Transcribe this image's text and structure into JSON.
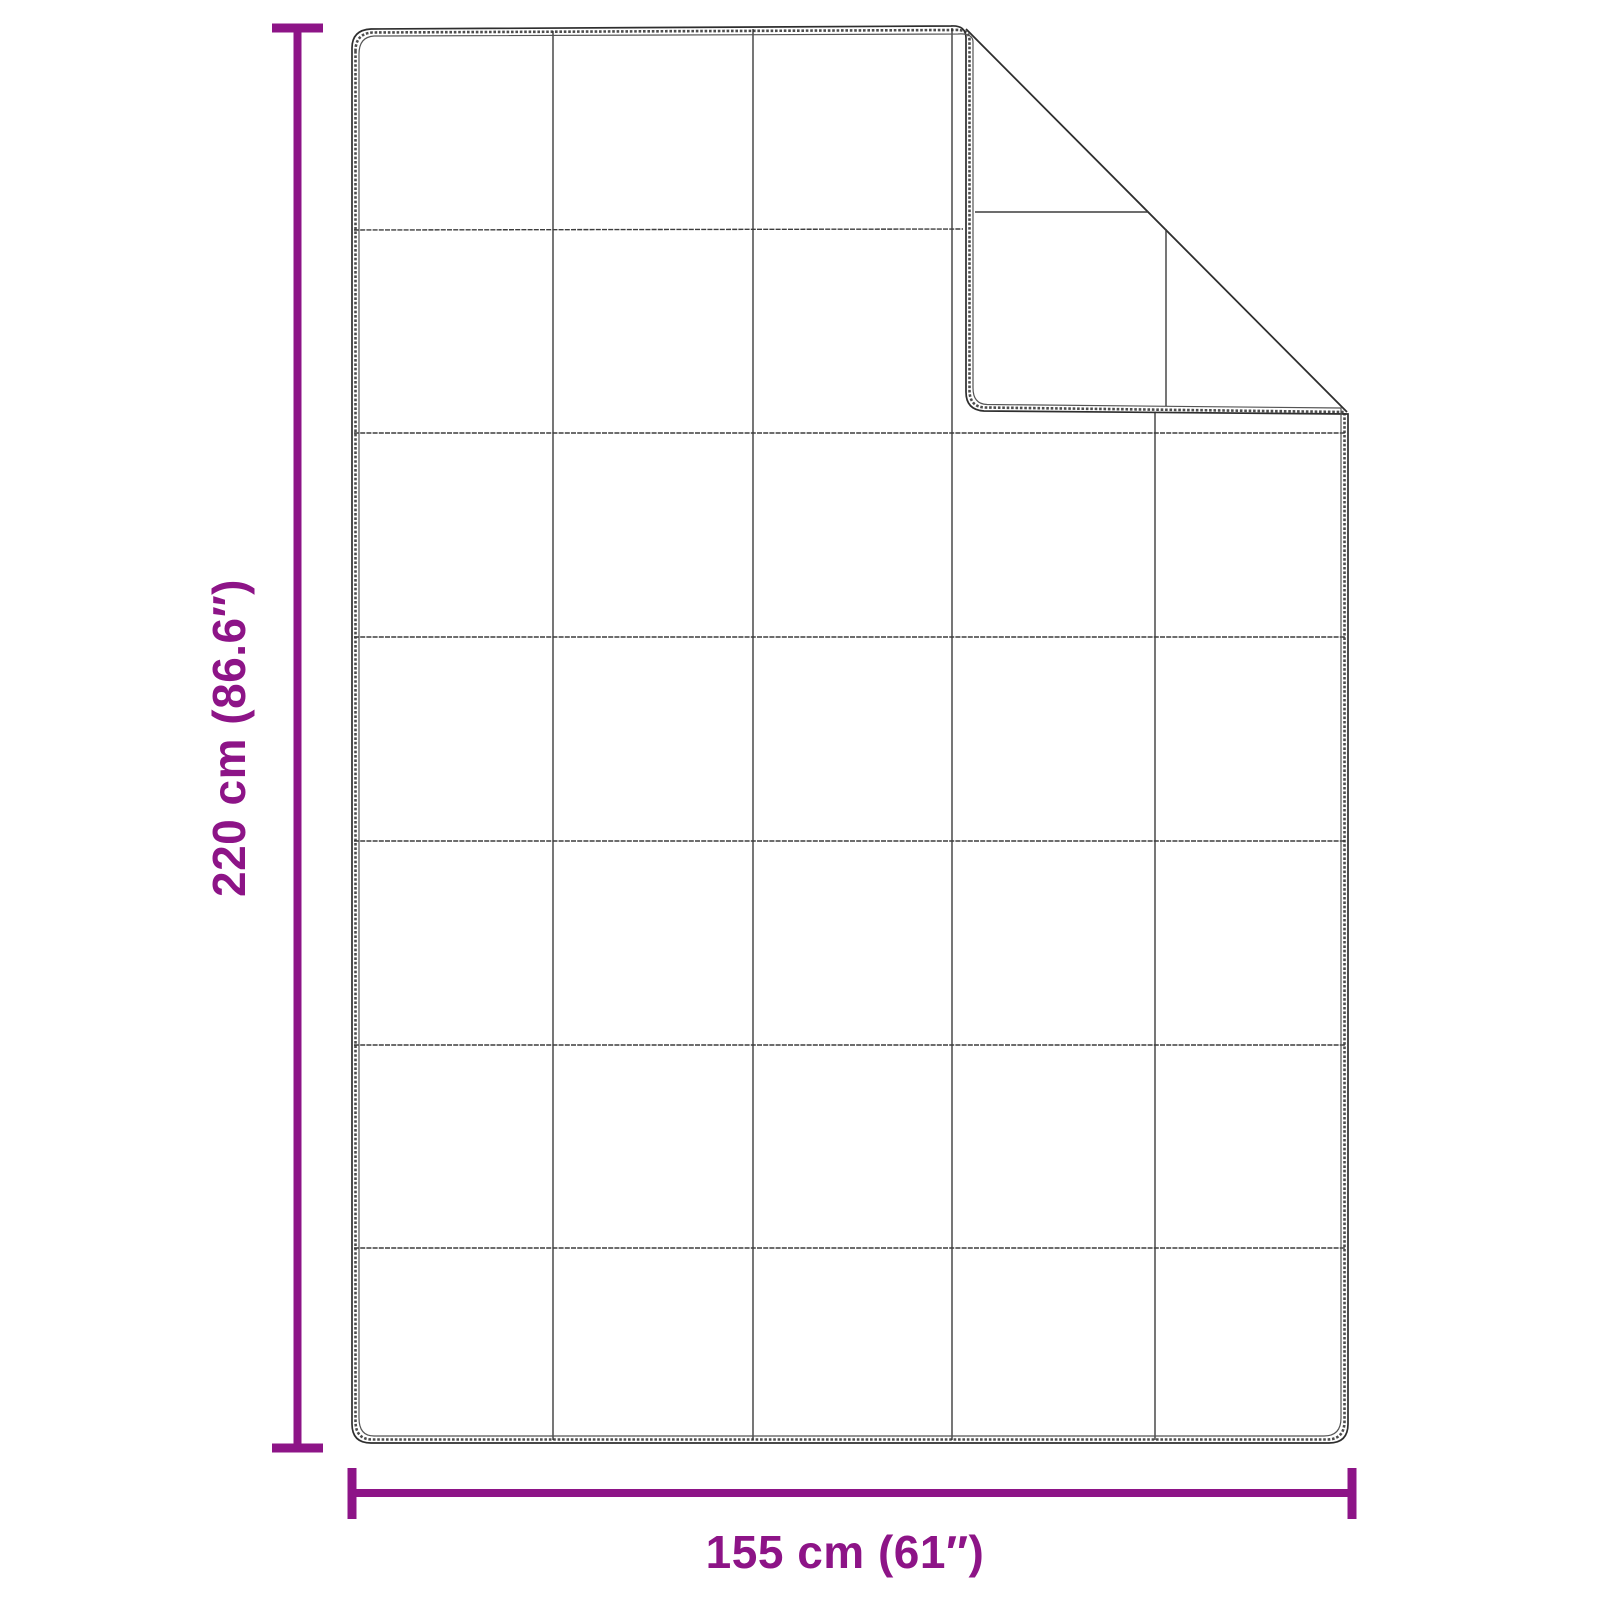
{
  "diagram": {
    "name": "weighted-blanket-dimension-diagram",
    "height_label": "220 cm (86.6″)",
    "width_label": "155 cm (61″)"
  },
  "colors": {
    "accent": "#8D1487",
    "outline": "#2e2e2e",
    "outline_light": "#555555",
    "grid": "#3d3d3d",
    "background": "#ffffff"
  }
}
